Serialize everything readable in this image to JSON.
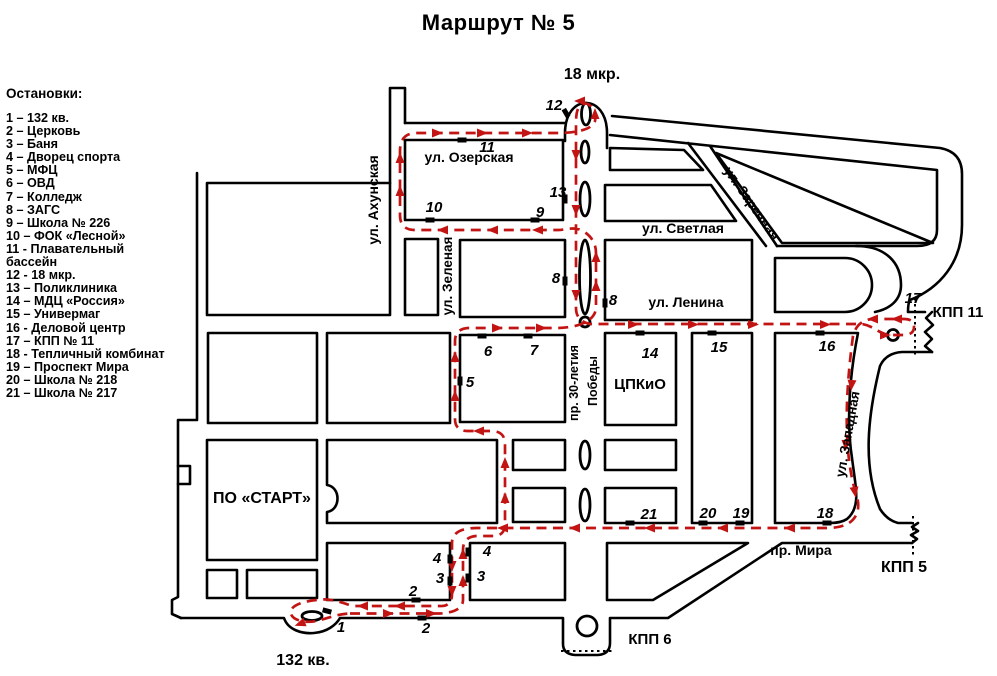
{
  "title": "Маршрут № 5",
  "colors": {
    "route": "#c31414",
    "ink": "#000000",
    "background": "#ffffff"
  },
  "legend": {
    "header": "Остановки:",
    "items": [
      "1 – 132 кв.",
      "2 – Церковь",
      "3 – Баня",
      "4 – Дворец спорта",
      "5 – МФЦ",
      "6 – ОВД",
      "7 – Колледж",
      "8 – ЗАГС",
      "9 – Школа № 226",
      "10 – ФОК «Лесной»",
      "11 - Плавательный бассейн",
      "12 - 18 мкр.",
      "13 – Поликлиника",
      "14 – МДЦ «Россия»",
      "15 – Универмаг",
      "16 - Деловой центр",
      "17 – КПП № 11",
      "18 - Тепличный комбинат",
      "19 – Проспект Мира",
      "20 – Школа № 218",
      "21 – Школа № 217"
    ]
  },
  "map": {
    "street_labels": [
      {
        "text": "ул. Ахунская",
        "x": 378,
        "y": 200,
        "rot": -90,
        "size": 14
      },
      {
        "text": "ул. Озерская",
        "x": 469,
        "y": 162,
        "rot": 0,
        "size": 14
      },
      {
        "text": "ул. Зеленая",
        "x": 452,
        "y": 276,
        "rot": -90,
        "size": 13.5
      },
      {
        "text": "ул. Светлая",
        "x": 683,
        "y": 233,
        "rot": 0,
        "size": 14
      },
      {
        "text": "ул. Заречная",
        "x": 748,
        "y": 206,
        "rot": 55,
        "size": 13.5
      },
      {
        "text": "ул. Ленина",
        "x": 686,
        "y": 307,
        "rot": 0,
        "size": 14
      },
      {
        "text": "пр. 30-летия",
        "x": 578,
        "y": 383,
        "rot": -90,
        "size": 12.5
      },
      {
        "text": "Победы",
        "x": 597,
        "y": 381,
        "rot": -90,
        "size": 12.5
      },
      {
        "text": "ЦПКиО",
        "x": 640,
        "y": 389,
        "rot": 0,
        "size": 15
      },
      {
        "text": "ул. Западная",
        "x": 852,
        "y": 435,
        "rot": -80,
        "size": 13.5
      },
      {
        "text": "пр. Мира",
        "x": 801,
        "y": 555,
        "rot": 0,
        "size": 14
      },
      {
        "text": "ПО «СТАРТ»",
        "x": 262,
        "y": 503,
        "rot": 0,
        "size": 16
      },
      {
        "text": "132 кв.",
        "x": 303,
        "y": 665,
        "rot": 0,
        "size": 16
      },
      {
        "text": "18 мкр.",
        "x": 592,
        "y": 79,
        "rot": 0,
        "size": 16
      },
      {
        "text": "КПП 11",
        "x": 958,
        "y": 317,
        "rot": 0,
        "size": 15
      },
      {
        "text": "КПП 5",
        "x": 904,
        "y": 572,
        "rot": 0,
        "size": 16
      },
      {
        "text": "КПП 6",
        "x": 650,
        "y": 644,
        "rot": 0,
        "size": 15
      }
    ],
    "stop_labels": [
      {
        "n": "1",
        "x": 341,
        "y": 632
      },
      {
        "n": "2",
        "x": 413,
        "y": 596
      },
      {
        "n": "2",
        "x": 426,
        "y": 633
      },
      {
        "n": "3",
        "x": 440,
        "y": 583
      },
      {
        "n": "3",
        "x": 481,
        "y": 581
      },
      {
        "n": "4",
        "x": 437,
        "y": 563
      },
      {
        "n": "4",
        "x": 487,
        "y": 556
      },
      {
        "n": "5",
        "x": 470,
        "y": 387
      },
      {
        "n": "6",
        "x": 488,
        "y": 356
      },
      {
        "n": "7",
        "x": 534,
        "y": 355
      },
      {
        "n": "8",
        "x": 556,
        "y": 283
      },
      {
        "n": "8",
        "x": 613,
        "y": 305
      },
      {
        "n": "9",
        "x": 540,
        "y": 217
      },
      {
        "n": "10",
        "x": 434,
        "y": 212
      },
      {
        "n": "11",
        "x": 487,
        "y": 152
      },
      {
        "n": "12",
        "x": 554,
        "y": 110
      },
      {
        "n": "13",
        "x": 558,
        "y": 197
      },
      {
        "n": "14",
        "x": 650,
        "y": 358
      },
      {
        "n": "15",
        "x": 719,
        "y": 352
      },
      {
        "n": "16",
        "x": 827,
        "y": 351
      },
      {
        "n": "17",
        "x": 913,
        "y": 303
      },
      {
        "n": "18",
        "x": 825,
        "y": 518
      },
      {
        "n": "19",
        "x": 741,
        "y": 518
      },
      {
        "n": "20",
        "x": 708,
        "y": 518
      },
      {
        "n": "21",
        "x": 649,
        "y": 519
      }
    ]
  }
}
